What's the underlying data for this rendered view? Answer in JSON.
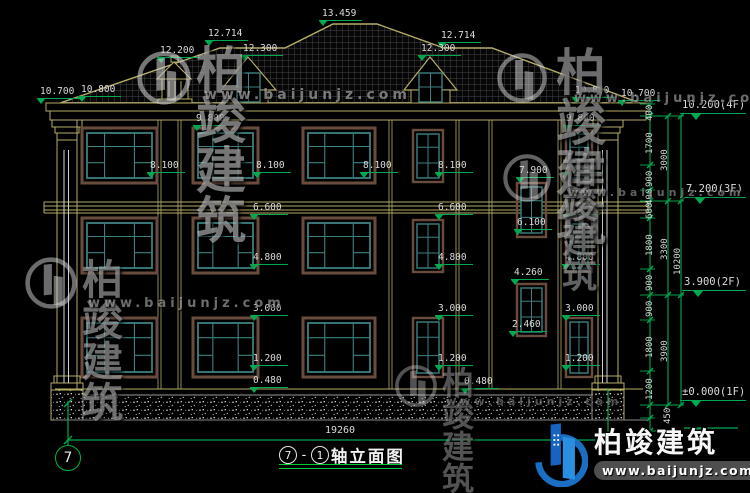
{
  "drawing": {
    "type": "building-elevation",
    "axis_bubble": "7",
    "title": {
      "axis_a": "7",
      "dash": "-",
      "axis_b": "1",
      "name": "轴立面图"
    },
    "bottom_dim": {
      "t": "19260"
    }
  },
  "colors": {
    "background": "#000000",
    "cad_yellow": "#b5ad68",
    "window_teal": "#3d8080",
    "window_surround": "#6a4c3f",
    "dimension_green": "#00a94f",
    "title_underline_green": "#00cc33",
    "text_white": "#dcdcdc",
    "logo_blue": "#1b6fc2"
  },
  "spot_levels": [
    {
      "t": "13.459",
      "x": 322,
      "y": 9
    },
    {
      "t": "12.714",
      "x": 208,
      "y": 29
    },
    {
      "t": "12.714",
      "x": 441,
      "y": 31
    },
    {
      "t": "12.200",
      "x": 160,
      "y": 46
    },
    {
      "t": "12.300",
      "x": 243,
      "y": 44
    },
    {
      "t": "12.300",
      "x": 421,
      "y": 44
    },
    {
      "t": "10.700",
      "x": 40,
      "y": 87
    },
    {
      "t": "10.800",
      "x": 81,
      "y": 85
    },
    {
      "t": "10.800",
      "x": 575,
      "y": 86
    },
    {
      "t": "10.700",
      "x": 621,
      "y": 89
    },
    {
      "t": "9.800",
      "x": 196,
      "y": 114
    },
    {
      "t": "9.800",
      "x": 566,
      "y": 114
    },
    {
      "t": "8.100",
      "x": 150,
      "y": 161
    },
    {
      "t": "8.100",
      "x": 256,
      "y": 161
    },
    {
      "t": "8.100",
      "x": 363,
      "y": 161
    },
    {
      "t": "8.100",
      "x": 438,
      "y": 161
    },
    {
      "t": "8.100",
      "x": 566,
      "y": 161
    },
    {
      "t": "7.900",
      "x": 519,
      "y": 166
    },
    {
      "t": "6.600",
      "x": 253,
      "y": 203
    },
    {
      "t": "6.600",
      "x": 438,
      "y": 203
    },
    {
      "t": "6.600",
      "x": 565,
      "y": 203
    },
    {
      "t": "6.100",
      "x": 517,
      "y": 218
    },
    {
      "t": "4.800",
      "x": 253,
      "y": 253
    },
    {
      "t": "4.800",
      "x": 438,
      "y": 253
    },
    {
      "t": "4.800",
      "x": 565,
      "y": 253
    },
    {
      "t": "4.260",
      "x": 514,
      "y": 268
    },
    {
      "t": "3.000",
      "x": 253,
      "y": 304
    },
    {
      "t": "3.000",
      "x": 438,
      "y": 304
    },
    {
      "t": "3.000",
      "x": 565,
      "y": 304
    },
    {
      "t": "2.460",
      "x": 512,
      "y": 320
    },
    {
      "t": "1.200",
      "x": 253,
      "y": 354
    },
    {
      "t": "1.200",
      "x": 438,
      "y": 354
    },
    {
      "t": "1.200",
      "x": 565,
      "y": 354
    },
    {
      "t": "0.480",
      "x": 253,
      "y": 376
    },
    {
      "t": "0.480",
      "x": 464,
      "y": 377
    }
  ],
  "right_chain": {
    "levels": [
      {
        "t": "10.200(4F)",
        "x": 682,
        "y": 100,
        "lw": 66
      },
      {
        "t": "7.200(3F)",
        "x": 686,
        "y": 184,
        "lw": 62
      },
      {
        "t": "3.900(2F)",
        "x": 684,
        "y": 277,
        "lw": 64
      },
      {
        "t": "±0.000(1F)",
        "x": 682,
        "y": 387,
        "lw": 66
      }
    ],
    "dims_inner": [
      {
        "t": "400",
        "x": 646,
        "y": 121
      },
      {
        "t": "1700",
        "x": 646,
        "y": 154
      },
      {
        "t": "900",
        "x": 646,
        "y": 187
      },
      {
        "t": "400",
        "x": 646,
        "y": 205
      },
      {
        "t": "600",
        "x": 646,
        "y": 219
      },
      {
        "t": "1800",
        "x": 646,
        "y": 256
      },
      {
        "t": "900",
        "x": 646,
        "y": 291
      },
      {
        "t": "900",
        "x": 646,
        "y": 317
      },
      {
        "t": "1800",
        "x": 646,
        "y": 358
      },
      {
        "t": "1200",
        "x": 646,
        "y": 400
      },
      {
        "t": "450",
        "x": 664,
        "y": 424
      }
    ],
    "dims_mid": [
      {
        "t": "3000",
        "x": 661,
        "y": 171
      },
      {
        "t": "3300",
        "x": 661,
        "y": 260
      },
      {
        "t": "3900",
        "x": 661,
        "y": 362
      }
    ],
    "dims_outer": [
      {
        "t": "10200",
        "x": 674,
        "y": 275
      }
    ]
  },
  "watermarks": [
    {
      "x": 136,
      "y": 50,
      "icon": 56,
      "text": "柏竣建筑",
      "url": "www.baijunjz.com",
      "tx": 60,
      "ty": -4,
      "fs": 50,
      "ux": 68,
      "uy": 38,
      "ufs": 14,
      "op": 0.55
    },
    {
      "x": 496,
      "y": 52,
      "icon": 52,
      "text": "柏竣建筑",
      "url": "www.baijunjz.com",
      "tx": 60,
      "ty": -4,
      "fs": 50,
      "ux": 78,
      "uy": 40,
      "ufs": 13,
      "op": 0.5
    },
    {
      "x": 24,
      "y": 256,
      "icon": 54,
      "text": "柏竣建筑",
      "url": "www.baijunjz.com",
      "tx": 58,
      "ty": 4,
      "fs": 41,
      "ux": 64,
      "uy": 41,
      "ufs": 13,
      "op": 0.5
    },
    {
      "x": 502,
      "y": 153,
      "icon": 50,
      "text": "柏竣建筑",
      "url": "www.baijunjz.com",
      "tx": 60,
      "ty": 2,
      "fs": 35,
      "ux": 66,
      "uy": 34,
      "ufs": 11,
      "op": 0.45
    },
    {
      "x": 394,
      "y": 364,
      "icon": 44,
      "text": "柏竣建筑",
      "url": "www.baijunjz.com",
      "tx": 48,
      "ty": 3,
      "fs": 32,
      "ux": 52,
      "uy": 32,
      "ufs": 11,
      "op": 0.38
    }
  ],
  "logo": {
    "brand": "柏竣建筑",
    "site": "www.baijunjz.com"
  }
}
